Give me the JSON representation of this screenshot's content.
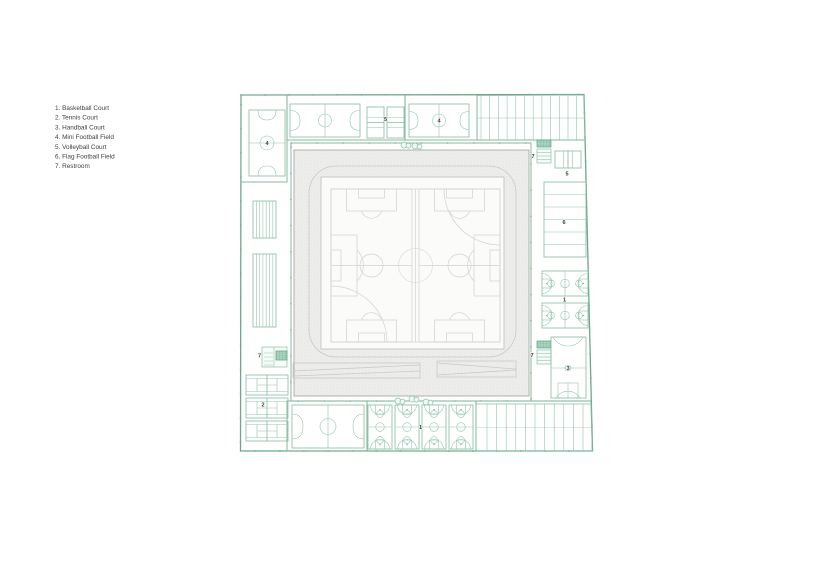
{
  "legend": {
    "items": [
      "1. Basketball Court",
      "2. Tennis Court",
      "3. Handball Court",
      "4. Mini Football Field",
      "5. Volleyball Court",
      "6. Flag Football Field",
      "7. Restroom"
    ]
  },
  "plan": {
    "labels": [
      {
        "id": "mini-football-left",
        "text": "4"
      },
      {
        "id": "volleyball-top",
        "text": "5"
      },
      {
        "id": "mini-football-top",
        "text": "4"
      },
      {
        "id": "restroom-top-right",
        "text": "7"
      },
      {
        "id": "volleyball-right",
        "text": "5"
      },
      {
        "id": "flag-football-right",
        "text": "6"
      },
      {
        "id": "basketball-right",
        "text": "1"
      },
      {
        "id": "restroom-mid-right",
        "text": "7"
      },
      {
        "id": "handball-right",
        "text": "3"
      },
      {
        "id": "restroom-left",
        "text": "7"
      },
      {
        "id": "tennis-left",
        "text": "2"
      },
      {
        "id": "basketball-bottom",
        "text": "1"
      }
    ]
  },
  "colors": {
    "line_green": "#7fb89d",
    "dark_green": "#58a081",
    "court_fill": "#ebf4ef",
    "stadium_gray": "#ededeb",
    "field_line_gray": "#d2d2d0",
    "label_text": "#3a3a3a"
  }
}
